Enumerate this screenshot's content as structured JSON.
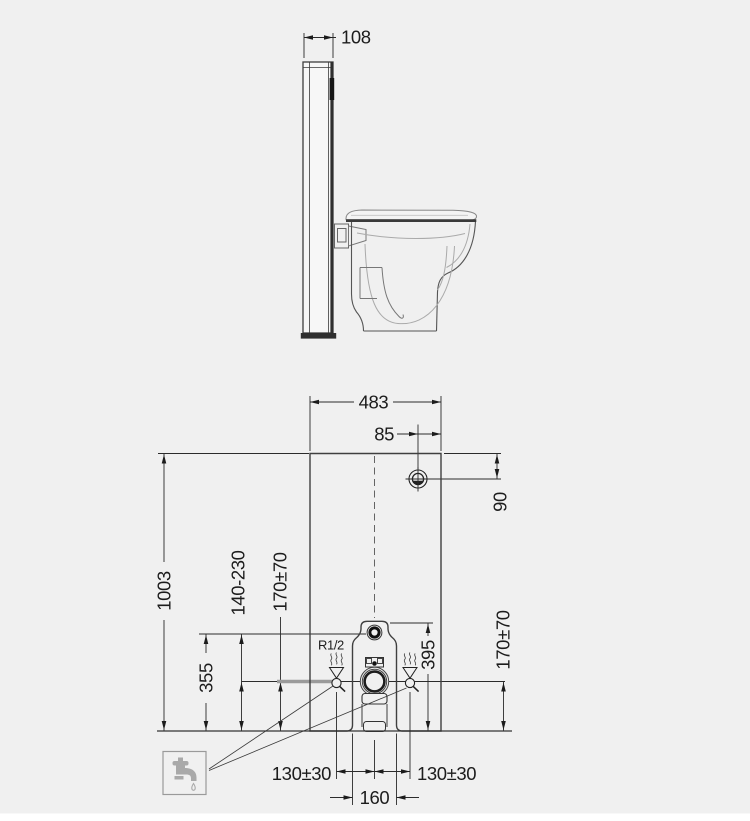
{
  "title": "sanitary-module-installation-drawing",
  "colors": {
    "background": "#f0f0f0",
    "line": "#2b2b2b",
    "supply_pipe_gray": "#9b9b9b",
    "tap_icon_gray": "#a9a9a9"
  },
  "side_view": {
    "depth": "108"
  },
  "front_view": {
    "width": "483",
    "fixing_offset": "85",
    "fixing_height": "90",
    "height": "1003",
    "supply_height": "355",
    "supply_range": "140-230",
    "flush_height_left": "170±70",
    "outlet_height": "395",
    "flush_height_right": "170±70",
    "thread": "R1/2",
    "left_offset": "130±30",
    "outlet_width": "160",
    "right_offset": "130±30"
  }
}
